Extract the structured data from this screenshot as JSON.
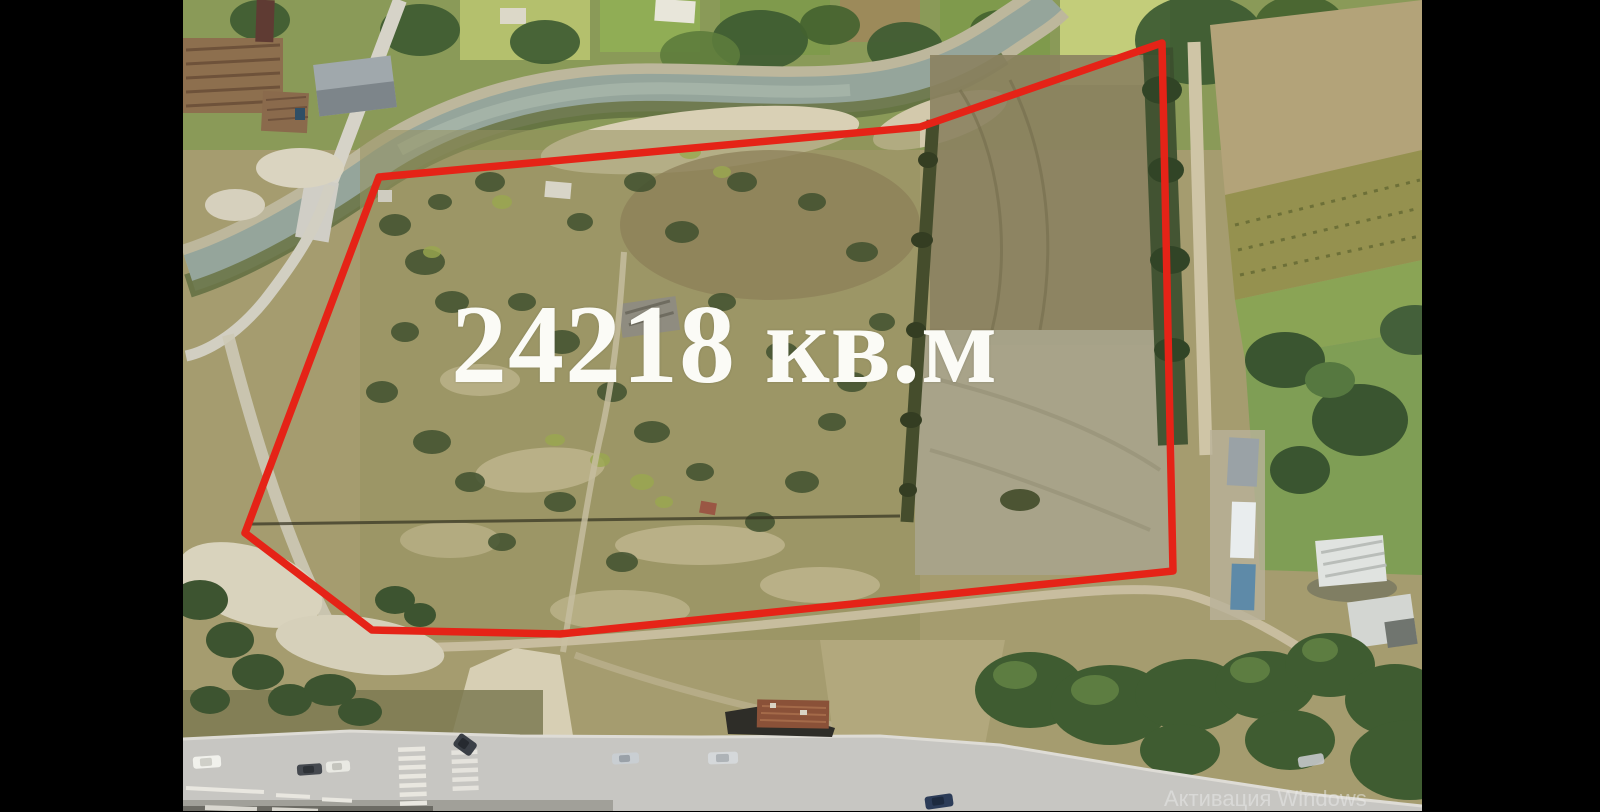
{
  "frame": {
    "area_label": "24218 кв.м",
    "watermark_text": "Активация Windows",
    "colors": {
      "plot_outline": "#e52317",
      "area_label_text": "#fbfbf6",
      "watermark_text": "#ececec",
      "letterbox": "#000000",
      "river_water": "#95a59b",
      "road_asphalt": "#c7c6c2"
    }
  }
}
